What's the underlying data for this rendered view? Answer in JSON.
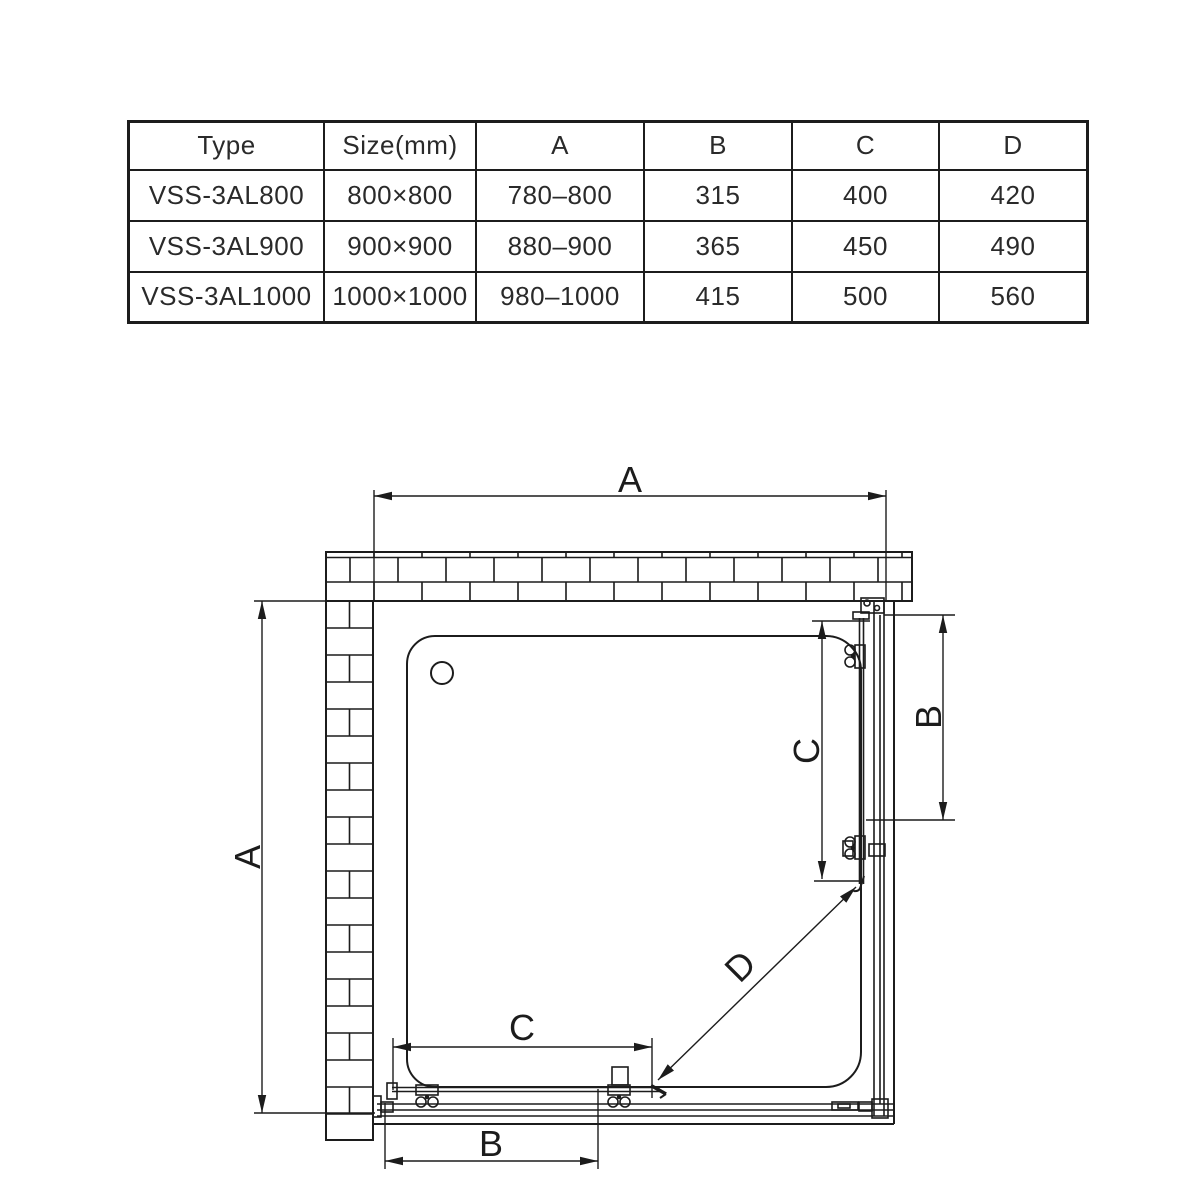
{
  "page": {
    "background": "#ffffff",
    "line_color": "#1c1c1c"
  },
  "spec_table": {
    "columns": [
      "Type",
      "Size(mm)",
      "A",
      "B",
      "C",
      "D"
    ],
    "rows": [
      {
        "type": "VSS-3AL800",
        "size": "800×800",
        "a": "780–800",
        "b": "315",
        "c": "400",
        "d": "420"
      },
      {
        "type": "VSS-3AL900",
        "size": "900×900",
        "a": "880–900",
        "b": "365",
        "c": "450",
        "d": "490"
      },
      {
        "type": "VSS-3AL1000",
        "size": "1000×1000",
        "a": "980–1000",
        "b": "415",
        "c": "500",
        "d": "560"
      }
    ]
  },
  "diagram": {
    "dim_labels": {
      "top_width": "A",
      "left_depth": "A",
      "right_door": "B",
      "right_opening": "C",
      "bottom_opening": "C",
      "bottom_door": "B",
      "diagonal": "D"
    }
  }
}
